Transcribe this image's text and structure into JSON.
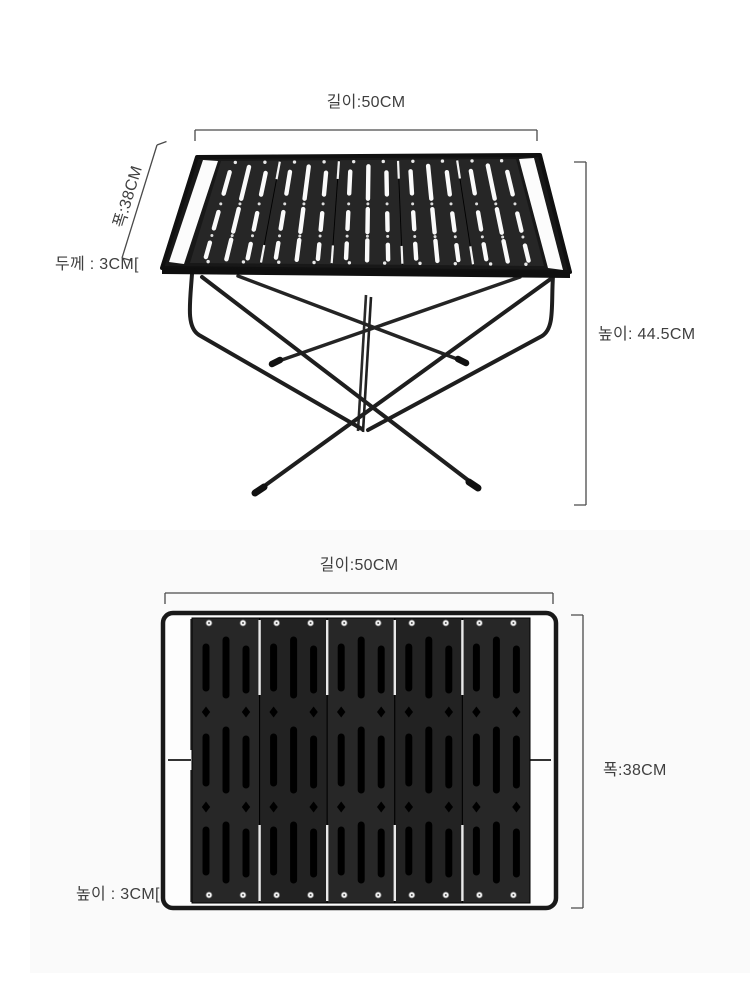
{
  "colors": {
    "product_dark": "#1e1e1e",
    "panel_dark": "#262626",
    "slot_white": "#fafafa",
    "slot_black": "#000000",
    "dimension_line": "#4a4a4a",
    "text": "#3f3f3f",
    "photo_background": "#fafafa",
    "page_background": "#ffffff"
  },
  "assembled_view": {
    "length_label": "길이:50CM",
    "width_label": "폭:38CM",
    "thickness_label": "두께 : 3CM[",
    "height_label": "높이: 44.5CM"
  },
  "folded_view": {
    "length_label": "길이:50CM",
    "width_label": "폭:38CM",
    "height_label": "높이 : 3CM["
  }
}
